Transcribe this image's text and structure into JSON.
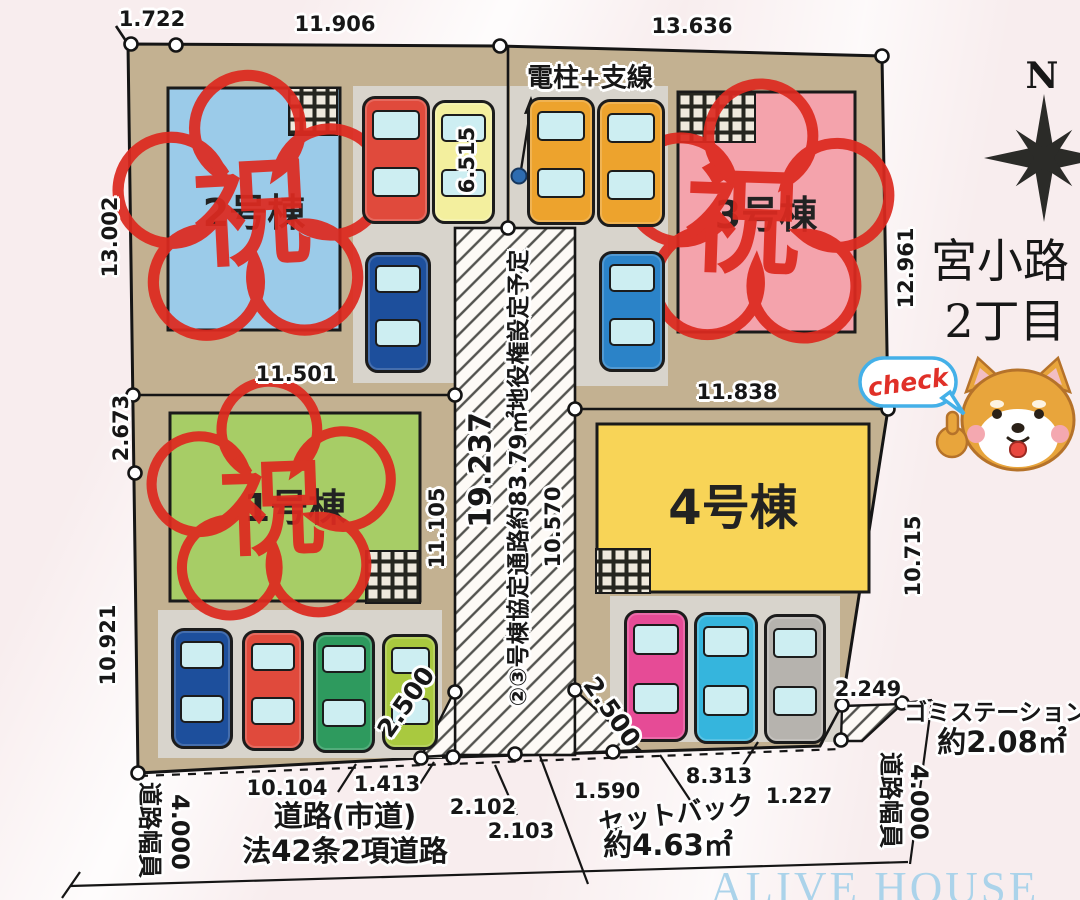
{
  "area_title": {
    "line1": "宮小路",
    "line2": "2丁目"
  },
  "compass": {
    "label": "N"
  },
  "mascot": {
    "bubble": "check"
  },
  "watermark": "ALIVE HOUSE",
  "stamp": {
    "text": "祝",
    "color": "#dd2a20"
  },
  "pole": {
    "label": "電柱+支線"
  },
  "road": {
    "name_line1": "道路(市道)",
    "name_line2": "法42条2項道路",
    "width_label_left": "道路幅員",
    "width_value_left": "4.000",
    "width_label_right": "道路幅員",
    "width_value_right": "4.000",
    "easement": "②③号棟協定通路約83.79㎡地役権設定予定",
    "length": "19.237",
    "setback_label": "セットバック",
    "setback_area": "約4.63㎡",
    "garbage_label": "ゴミステーション",
    "garbage_area": "約2.08㎡"
  },
  "buildings": [
    {
      "label": "1号棟",
      "color": "#a7cd66"
    },
    {
      "label": "2号棟",
      "color": "#9bcbe9"
    },
    {
      "label": "3号棟",
      "color": "#f4a3ac"
    },
    {
      "label": "4号棟",
      "color": "#f8d457"
    }
  ],
  "dimensions": {
    "top_offset": "1.722",
    "top_lot2": "11.906",
    "top_lot3": "13.636",
    "left_lot2": "13.002",
    "left_offset": "2.673",
    "left_lot1": "10.921",
    "right_lot3": "12.961",
    "right_lot4": "10.715",
    "right_garbage": "2.249",
    "between_left": "11.501",
    "between_right": "11.838",
    "road_top": "6.515",
    "road_side_lot1": "11.105",
    "road_side_lot4": "10.570",
    "splay_left": "2.500",
    "splay_right": "2.500",
    "bottom_lot1": "10.104",
    "bottom_1413": "1.413",
    "bottom_2102": "2.102",
    "bottom_2103": "2.103",
    "bottom_1590": "1.590",
    "bottom_8313": "8.313",
    "bottom_1227": "1.227"
  },
  "cars": [
    "#e04a3c",
    "#f3ef9e",
    "#1d4f9c",
    "#eda32d",
    "#eda32d",
    "#2b83c8",
    "#1d4f9c",
    "#e04a3c",
    "#2e9a5e",
    "#a9c93f",
    "#e64b96",
    "#35b5dd",
    "#b6b3ae"
  ]
}
